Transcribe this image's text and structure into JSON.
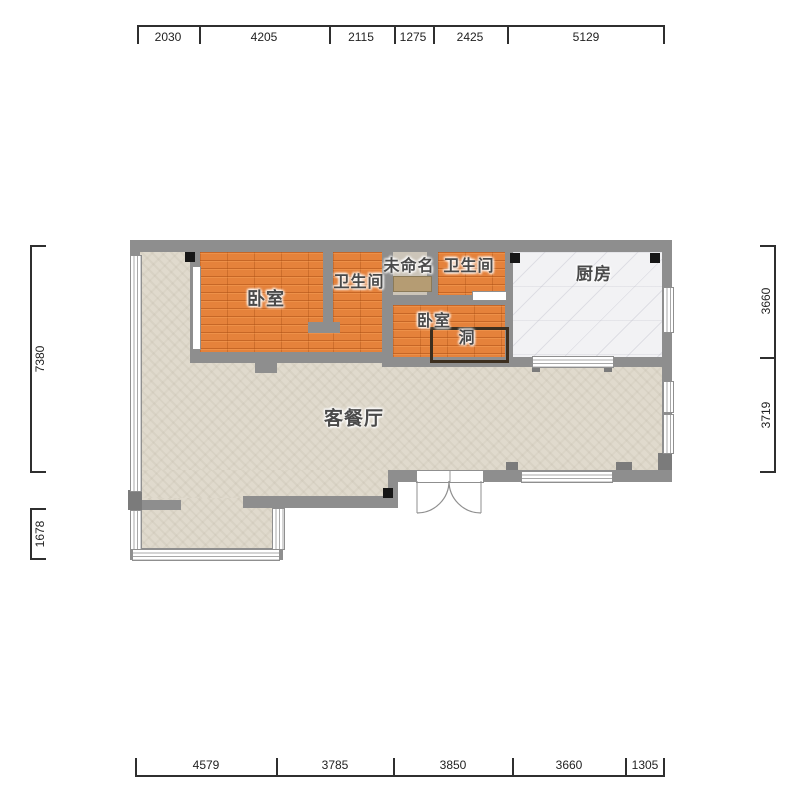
{
  "rooms": {
    "bedroom1": {
      "label": "卧室"
    },
    "bathroom1": {
      "label": "卫生间"
    },
    "unnamed": {
      "label": "未命名"
    },
    "bathroom2": {
      "label": "卫生间"
    },
    "kitchen": {
      "label": "厨房"
    },
    "bedroom2": {
      "label": "卧室"
    },
    "hole": {
      "label": "洞"
    },
    "living": {
      "label": "客餐厅"
    }
  },
  "dims": {
    "top": [
      "2030",
      "4205",
      "2115",
      "1275",
      "2425",
      "5129"
    ],
    "bottom": [
      "4579",
      "3785",
      "3850",
      "3660",
      "1305"
    ],
    "left": [
      "7380",
      "1678"
    ],
    "right": [
      "3660",
      "3719"
    ]
  },
  "colors": {
    "wall": "#8e8e8e",
    "bedroom_floor": "#e5823b",
    "living_floor": "#e0dacd",
    "kitchen_floor": "#f2f2f4",
    "unnamed_floor": "#ccc5b9",
    "corner_marker": "#161616",
    "dimension": "#2f2f2f"
  }
}
